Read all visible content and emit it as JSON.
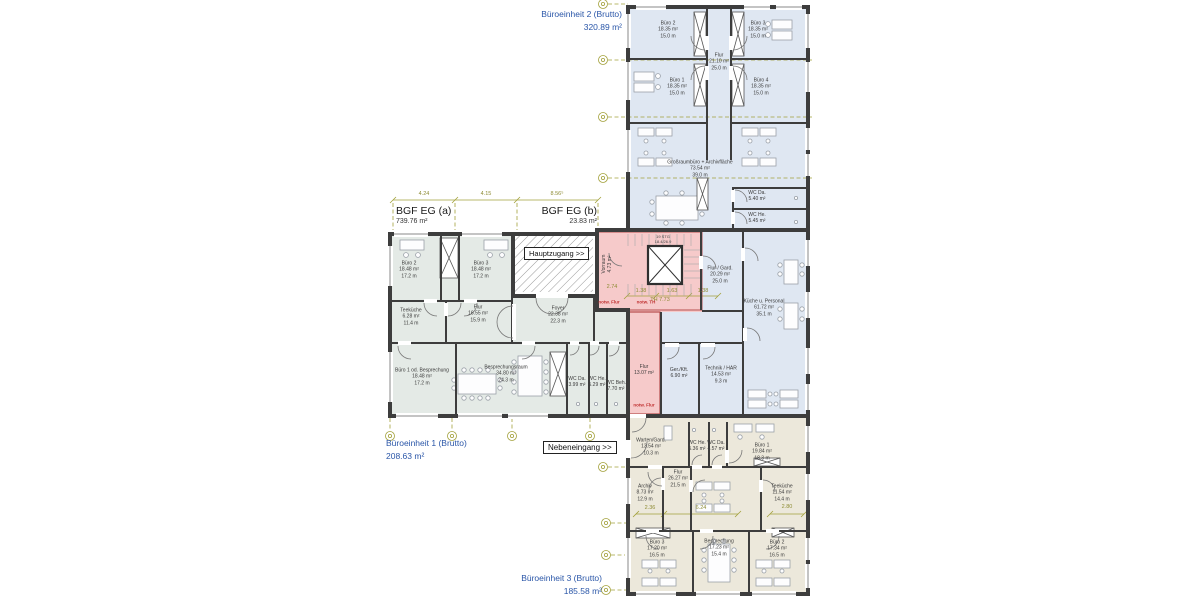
{
  "drawing": {
    "type": "architectural-floor-plan",
    "units": {
      "unit2": {
        "line1": "Büroeinheit 2 (Brutto)",
        "line2": "320.89 m²"
      },
      "unit1": {
        "line1": "Büroeinheit 1 (Brutto)",
        "line2": "208.63 m²"
      },
      "unit3": {
        "line1": "Büroeinheit 3 (Brutto)",
        "line2": "185.58 m²"
      },
      "bgf_a": {
        "line1": "BGF EG (a)",
        "line2": "739.76 m²"
      },
      "bgf_b": {
        "line1": "BGF EG (b)",
        "line2": "23.83 m²"
      }
    },
    "entrances": {
      "main": "Hauptzugang >>",
      "side": "Nebeneingang >>"
    },
    "stair_note": {
      "line1": "19 STG",
      "line2": "18.4/26.9",
      "x": 663,
      "y": 240
    }
  },
  "rooms": [
    {
      "name": "Büro 2",
      "area": "18.35 m²",
      "len": "15.0 m",
      "x": 668,
      "y": 30
    },
    {
      "name": "Büro 3",
      "area": "18.35 m²",
      "len": "15.0 m",
      "x": 758,
      "y": 30
    },
    {
      "name": "Flur",
      "area": "21.10 m²",
      "len": "25.0 m",
      "x": 719,
      "y": 62
    },
    {
      "name": "Büro 1",
      "area": "18.35 m²",
      "len": "15.0 m",
      "x": 677,
      "y": 87
    },
    {
      "name": "Büro 4",
      "area": "18.35 m²",
      "len": "15.0 m",
      "x": 761,
      "y": 87
    },
    {
      "name": "Großraumbüro + Archivfläche",
      "area": "73.54 m²",
      "len": "39.0 m",
      "x": 700,
      "y": 169
    },
    {
      "name": "WC Da.",
      "area": "5.40 m²",
      "len": "",
      "x": 757,
      "y": 196
    },
    {
      "name": "WC He.",
      "area": "5.45 m²",
      "len": "",
      "x": 757,
      "y": 218
    },
    {
      "name": "Flur / Gard.",
      "area": "20.29 m²",
      "len": "25.0 m",
      "x": 720,
      "y": 275
    },
    {
      "name": "Küche u. Personal",
      "area": "61.72 m²",
      "len": "35.1 m",
      "x": 764,
      "y": 308
    },
    {
      "name": "Vorraum",
      "area": "4.73 m²",
      "len": "",
      "x": 607,
      "y": 264,
      "rot": 1
    },
    {
      "name": "Flur",
      "area": "13.07 m²",
      "len": "",
      "x": 644,
      "y": 370
    },
    {
      "name": "Ger./Kft.",
      "area": "6.90 m²",
      "len": "",
      "x": 679,
      "y": 373
    },
    {
      "name": "Technik / HAR",
      "area": "14.53 m²",
      "len": "9.3 m",
      "x": 721,
      "y": 375
    },
    {
      "name": "Büro 2",
      "area": "18.48 m²",
      "len": "17.2 m",
      "x": 409,
      "y": 270
    },
    {
      "name": "Büro 3",
      "area": "18.48 m²",
      "len": "17.2 m",
      "x": 481,
      "y": 270
    },
    {
      "name": "Teeküche",
      "area": "6.28 m²",
      "len": "11.4 m",
      "x": 411,
      "y": 317
    },
    {
      "name": "Flur",
      "area": "16.55 m²",
      "len": "15.9 m",
      "x": 478,
      "y": 314
    },
    {
      "name": "Foyer",
      "area": "22.38 m²",
      "len": "22.3 m",
      "x": 558,
      "y": 315
    },
    {
      "name": "Büro 1 od. Besprechung",
      "area": "18.48 m²",
      "len": "17.2 m",
      "x": 422,
      "y": 377
    },
    {
      "name": "Besprechungsraum",
      "area": "34.80 m²",
      "len": "24.3 m",
      "x": 506,
      "y": 374
    },
    {
      "name": "WC Da.",
      "area": "3.99 m²",
      "len": "",
      "x": 577,
      "y": 382
    },
    {
      "name": "WC He.",
      "area": "5.29 m²",
      "len": "",
      "x": 597,
      "y": 382
    },
    {
      "name": "WC Beh.",
      "area": "7.70 m²",
      "len": "",
      "x": 616,
      "y": 386
    },
    {
      "name": "Warten/Gard.",
      "area": "13.54 m²",
      "len": "10.3 m",
      "x": 651,
      "y": 447
    },
    {
      "name": "WC He.",
      "area": "5.36 m²",
      "len": "",
      "x": 697,
      "y": 446
    },
    {
      "name": "WC Da.",
      "area": "4.57 m²",
      "len": "",
      "x": 716,
      "y": 446
    },
    {
      "name": "Büro 1",
      "area": "19.84 m²",
      "len": "18.3 m",
      "x": 762,
      "y": 452
    },
    {
      "name": "Flur",
      "area": "26.27 m²",
      "len": "21.5 m",
      "x": 678,
      "y": 479
    },
    {
      "name": "Archiv",
      "area": "8.73 m²",
      "len": "12.9 m",
      "x": 645,
      "y": 493
    },
    {
      "name": "Teeküche",
      "area": "11.54 m²",
      "len": "14.4 m",
      "x": 782,
      "y": 493
    },
    {
      "name": "Büro 3",
      "area": "17.20 m²",
      "len": "16.5 m",
      "x": 657,
      "y": 549
    },
    {
      "name": "Besprechung",
      "area": "17.23 m²",
      "len": "15.4 m",
      "x": 719,
      "y": 548
    },
    {
      "name": "Büro 2",
      "area": "17.34 m²",
      "len": "16.5 m",
      "x": 777,
      "y": 549
    }
  ],
  "dimensions": [
    {
      "t": "4.24",
      "x": 424,
      "y": 197
    },
    {
      "t": "4.15",
      "x": 486,
      "y": 197
    },
    {
      "t": "8.56⁵",
      "x": 557,
      "y": 197
    },
    {
      "t": "2.74",
      "x": 612,
      "y": 290
    },
    {
      "t": "1.38",
      "x": 641,
      "y": 294
    },
    {
      "t": "1.63",
      "x": 672,
      "y": 294
    },
    {
      "t": "1.38",
      "x": 703,
      "y": 294
    },
    {
      "t": "TH 7.73",
      "x": 660,
      "y": 303
    },
    {
      "t": "2.36",
      "x": 650,
      "y": 511
    },
    {
      "t": "6.24",
      "x": 701,
      "y": 511
    },
    {
      "t": "2.80",
      "x": 787,
      "y": 510
    }
  ],
  "escape_labels": [
    {
      "t": "notw. Flur",
      "x": 609,
      "y": 302
    },
    {
      "t": "notw. TH",
      "x": 646,
      "y": 302
    },
    {
      "t": "notw. Flur",
      "x": 644,
      "y": 405
    }
  ],
  "colors": {
    "wall": "#3d3d3d",
    "unit_label_blue": "#2a56a8",
    "escape_red": "#c03030",
    "grid_olive": "#8e8c35",
    "fill_office_blue": "#dfe7f2",
    "fill_office_green": "#e4eae6",
    "fill_office_beige": "#ece8db",
    "fill_escape_pink": "#f6caca"
  }
}
